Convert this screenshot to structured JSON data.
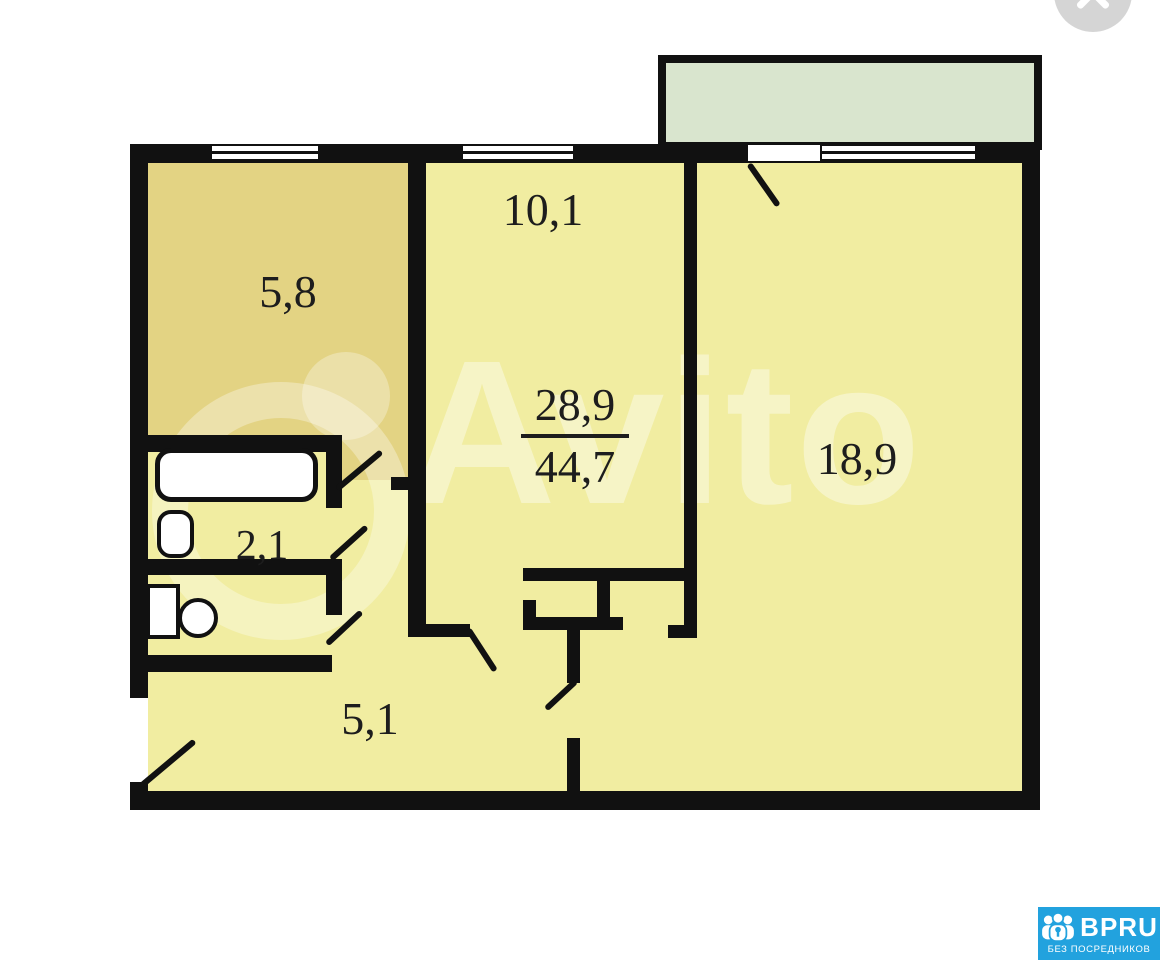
{
  "viewer": {
    "close_icon": "x"
  },
  "watermark": {
    "text": "Avito"
  },
  "plan": {
    "kitchen_area": "5,8",
    "room_small_area": "10,1",
    "room_large_area": "18,9",
    "bathroom_area": "2,1",
    "hallway_area": "5,1",
    "living_area": "28,9",
    "total_area": "44,7"
  },
  "badge": {
    "brand": "BPRU",
    "tagline": "БЕЗ ПОСРЕДНИКОВ"
  },
  "colors": {
    "wall": "#111111",
    "floor": "#f1eda1",
    "kitchen": "#e3d383",
    "balcony": "#d9e5ce",
    "badge": "#22a2de",
    "close": "#d5d5d5"
  }
}
